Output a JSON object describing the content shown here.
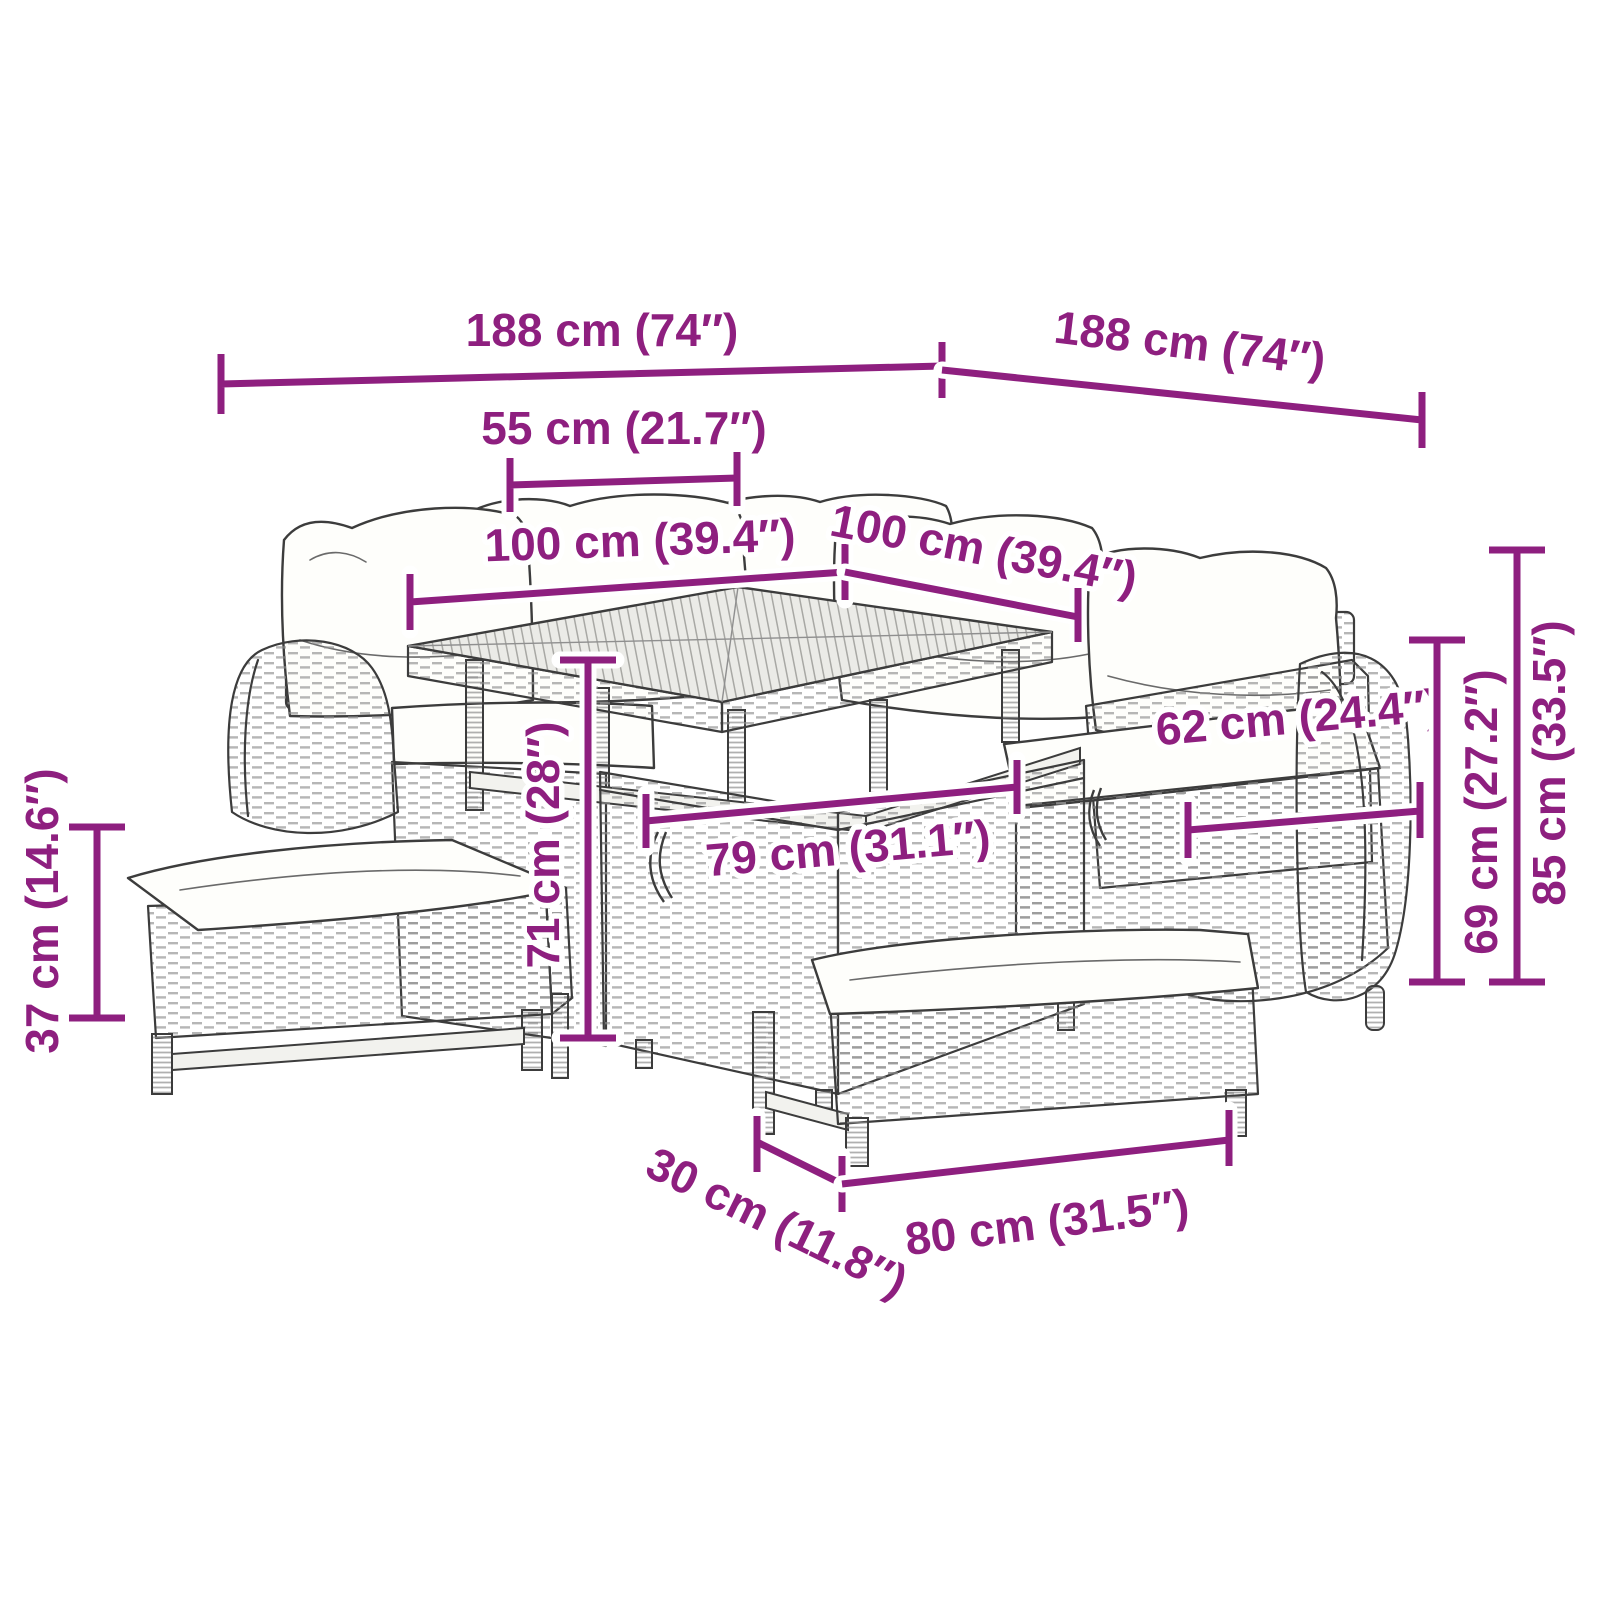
{
  "diagram": {
    "kind": "furniture-dimension-diagram",
    "background": "#ffffff",
    "accent_color": "#8e1f7f",
    "line_art_color": "#3c3c3c",
    "cushion_color": "#fefefb"
  },
  "dims": [
    {
      "id": "overall-width-left",
      "label": "188 cm (74″)"
    },
    {
      "id": "overall-depth-right",
      "label": "188 cm (74″)"
    },
    {
      "id": "table-top-depth",
      "label": "55 cm (21.7″)"
    },
    {
      "id": "table-top-width-left",
      "label": "100 cm (39.4″)"
    },
    {
      "id": "table-top-width-right",
      "label": "100 cm (39.4″)"
    },
    {
      "id": "backrest-height",
      "label": "62 cm (24.4″)"
    },
    {
      "id": "table-base-width",
      "label": "79 cm (31.1″)"
    },
    {
      "id": "table-height",
      "label": "71 cm (28″)"
    },
    {
      "id": "back-height",
      "label": "69 cm (27.2″)"
    },
    {
      "id": "total-height",
      "label": "85 cm (33.5″)"
    },
    {
      "id": "bench-height",
      "label": "37 cm (14.6″)"
    },
    {
      "id": "bench-depth",
      "label": "30 cm (11.8″)"
    },
    {
      "id": "bench-width",
      "label": "80 cm (31.5″)"
    }
  ]
}
